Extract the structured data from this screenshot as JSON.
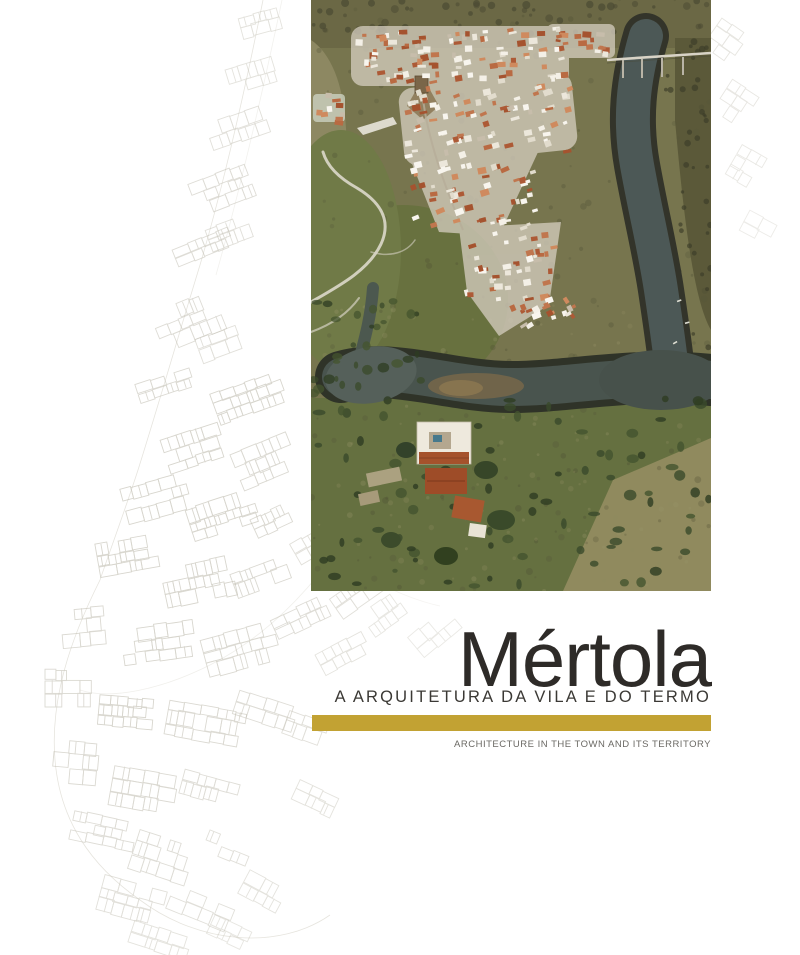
{
  "cover": {
    "title": "Mértola",
    "subtitle_pt": "A ARQUITETURA DA VILA E DO TERMO",
    "subtitle_en": "ARCHITECTURE IN THE TOWN AND ITS TERRITORY"
  },
  "colors": {
    "accent_gold": "#C2A233",
    "title_text": "#2E2B28",
    "subtitle_text": "#3B3935",
    "subtitle_en_text": "#6B6964"
  },
  "images": {
    "aerial_photo": "aerial-view-of-mertola-town-castle-and-guadiana-river",
    "background_plan": "faint-architectural-town-plan-line-drawing"
  }
}
